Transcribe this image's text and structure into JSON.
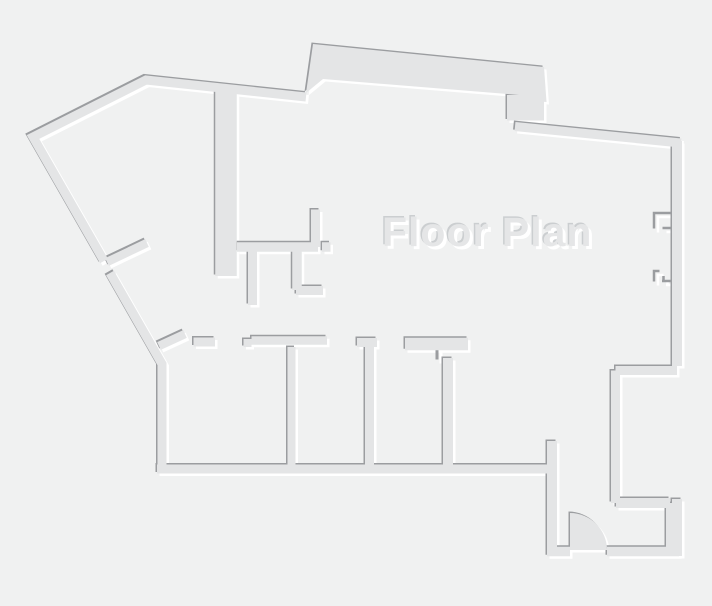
{
  "title": {
    "text": "Floor Plan"
  },
  "canvas": {
    "width": 712,
    "height": 606
  },
  "colors": {
    "background": "#f0f1f1",
    "wall_fill": "#e4e5e6",
    "wall_shadow_dark": "#9b9da0",
    "wall_highlight": "#ffffff",
    "title_fill": "#e5e6e7",
    "title_highlight": "#ffffff",
    "title_shadow_dark": "#cbced0"
  },
  "floor_plan": {
    "emboss": {
      "highlight_offset": [
        2.5,
        2.5
      ],
      "shadow_offset": [
        -1.5,
        -1.5
      ]
    },
    "walls": [
      {
        "name": "outer-upper-left-and-top",
        "d": "M 104,261 L 33,137 L 146,80 L 306,97",
        "w": 9
      },
      {
        "name": "outer-lower-left-and-west",
        "d": "M 110,273 L 162,364 L 162,473",
        "w": 9
      },
      {
        "name": "rooms-bottom",
        "d": "M 157,469 L 552,469",
        "w": 9
      },
      {
        "name": "entry-left",
        "d": "M 552,441 L 552,556",
        "w": 10
      },
      {
        "name": "entry-bottom-left",
        "d": "M 547,551.5 L 570,551.5",
        "w": 9.5
      },
      {
        "name": "entry-bottom-right",
        "d": "M 607,551.5 L 679,551.5",
        "w": 9.5
      },
      {
        "name": "entry-right-thick",
        "d": "M 672.5,503 L 672.5,551",
        "w": 13
      },
      {
        "name": "recess-bottom",
        "d": "M 616,503 L 670,503",
        "w": 10
      },
      {
        "name": "recess-left",
        "d": "M 615.5,370.5 L 615.5,503",
        "w": 9
      },
      {
        "name": "recess-step",
        "d": "M 615.5,370.5 L 677,370.5",
        "w": 9
      },
      {
        "name": "right-wall-upper",
        "d": "M 677,141 L 677,366",
        "w": 10
      },
      {
        "name": "right-wall-lower",
        "d": "M 677,499 L 677,556",
        "w": 10
      },
      {
        "name": "top-right-band",
        "d": "M 515,126.5 L 681,143",
        "w": 9
      },
      {
        "name": "interior-thick-vertical",
        "d": "M 226,91 L 226,276",
        "w": 21.5
      },
      {
        "name": "small-room-horizontal-a",
        "d": "M 237,247 L 318,247",
        "w": 9.5
      },
      {
        "name": "small-room-horizontal-b",
        "d": "M 322,247 L 330.5,247",
        "w": 9.5
      },
      {
        "name": "small-room-vertical",
        "d": "M 315.5,209.5 L 315.5,247",
        "w": 9
      },
      {
        "name": "closet-stub-left",
        "d": "M 252.5,251 L 252.5,305",
        "w": 9
      },
      {
        "name": "closet-stub-right",
        "d": "M 297,251 L 297,290",
        "w": 9.5
      },
      {
        "name": "closet-ell",
        "d": "M 296,290.5 L 323,290.5",
        "w": 9
      },
      {
        "name": "diagonal-stub-upper",
        "d": "M 107,262 L 147,243",
        "w": 8.5
      },
      {
        "name": "diagonal-stub-lower",
        "d": "M 159,346 L 185,334",
        "w": 8.5
      },
      {
        "name": "rooms-top-stub",
        "d": "M 193.5,342 L 215,342",
        "w": 9
      },
      {
        "name": "rooms-top-jamb",
        "d": "M 247.5,339 L 247.5,347",
        "w": 8
      },
      {
        "name": "rooms-top-long",
        "d": "M 251.5,340.5 L 327,340.5",
        "w": 8.5
      },
      {
        "name": "room-divider-1",
        "d": "M 291.5,347 L 291.5,469",
        "w": 8
      },
      {
        "name": "rooms-top-header-2",
        "d": "M 357,342.5 L 377,342.5",
        "w": 9
      },
      {
        "name": "room-divider-2",
        "d": "M 369.5,345 L 369.5,469",
        "w": 9
      },
      {
        "name": "rooms-top-header-3",
        "d": "M 405,344 L 468,344",
        "w": 12.5
      },
      {
        "name": "room-divider-3",
        "d": "M 448,358 L 448,469",
        "w": 10
      }
    ],
    "polygons": [
      {
        "name": "top-bump",
        "d": "M 306,93 L 313,44 L 544,67 L 546.5,102 L 519,100 L 519,95 L 323,79 Z"
      },
      {
        "name": "pillar-under-bump",
        "d": "M 507,95 L 544,95 L 544,120.5 L 507,120.5 Z"
      },
      {
        "name": "entry-door-swing",
        "d": "M 570,550 L 570,513 A 37,37 0 0 1 607,550 Z"
      }
    ],
    "thin_details": [
      {
        "name": "window-notch-1-bracket",
        "d": "M 672,214.5 L 655.5,214.5 L 655.5,230",
        "w": 2.5
      },
      {
        "name": "window-notch-1-sill",
        "d": "M 664,229.5 L 673,229.5",
        "w": 2.5
      },
      {
        "name": "window-notch-2-bracket",
        "d": "M 661,272.5 L 655.5,272.5 L 655.5,283",
        "w": 2.5
      },
      {
        "name": "window-notch-2-mullion",
        "d": "M 665,277.5 L 665,283",
        "w": 2.5
      },
      {
        "name": "window-notch-2-sill",
        "d": "M 663.5,282.5 L 673,282.5",
        "w": 2.5
      },
      {
        "name": "header-3-tick",
        "d": "M 438.5,350 L 438.5,361",
        "w": 3
      }
    ]
  }
}
